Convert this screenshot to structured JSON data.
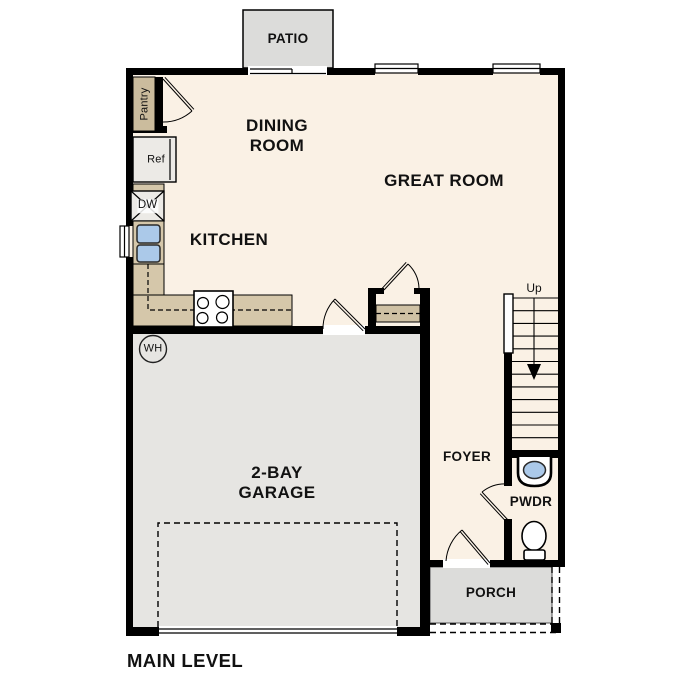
{
  "plan": {
    "title": "MAIN LEVEL",
    "rooms": {
      "patio": "PATIO",
      "dining": "DINING\nROOM",
      "great": "GREAT ROOM",
      "kitchen": "KITCHEN",
      "garage": "2-BAY\nGARAGE",
      "foyer": "FOYER",
      "powder": "PWDR",
      "porch": "PORCH"
    },
    "fixtures": {
      "pantry": "Pantry",
      "fridge": "Ref",
      "dishwasher": "DW",
      "water_heater": "WH",
      "stairs_direction": "Up"
    },
    "colors": {
      "floor": "#FAF1E5",
      "garage": "#E6E5E2",
      "patio": "#DCDCDA",
      "porch": "#DCDCDA",
      "counter": "#D5C7AA",
      "pantry": "#CBBC9D",
      "shelf": "#CFC1A4",
      "sink": "#ABC9E9",
      "wall": "#000000"
    }
  }
}
